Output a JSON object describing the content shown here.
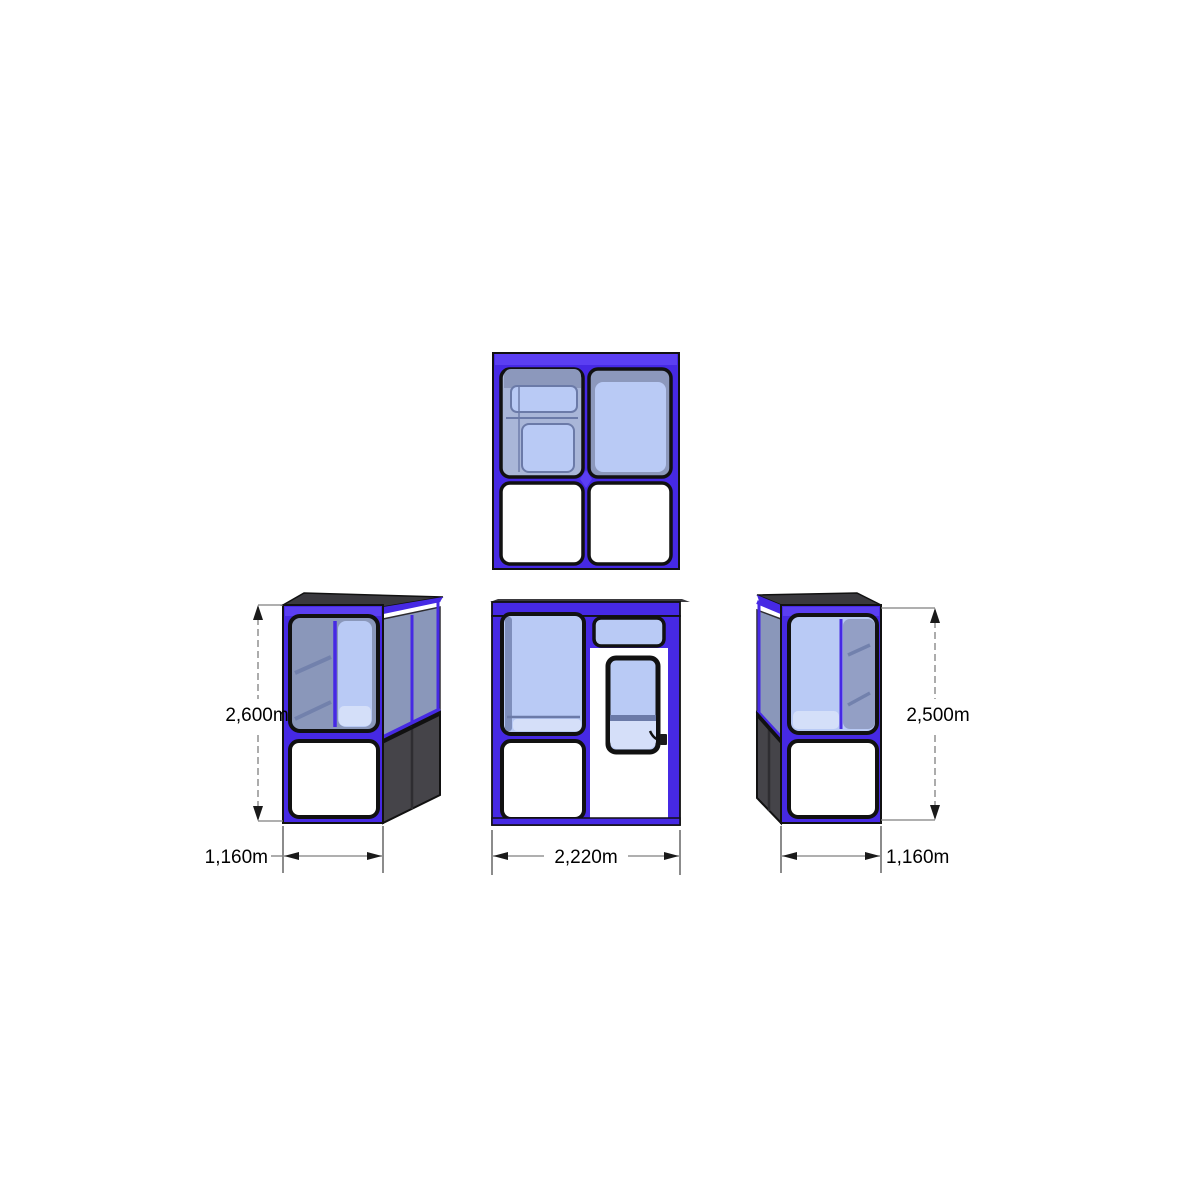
{
  "title": "kiosk-booth-orthographic-drawing",
  "colors": {
    "page_bg": "#ffffff",
    "frame_blue": "#4629E4",
    "frame_blue_light": "#5B3FF2",
    "outline": "#111111",
    "glass_light": "#B9CAF5",
    "glass_lighter": "#D5DFF9",
    "glass_mid": "#A9B6D8",
    "glass_tint": "#8C98BC",
    "glass_side": "#8A97BA",
    "divider_blue": "#6B7AA8",
    "side_dark": "#454449",
    "side_seam": "#2E2D31",
    "roof_dark": "#3A393E",
    "panel_white": "#FFFFFF",
    "dim_gray": "#7F7F7F",
    "dim_black": "#1A1A1A",
    "text": "#000000"
  },
  "views": {
    "top": {
      "name": "top plan view"
    },
    "left": {
      "name": "left perspective view",
      "height_label": "2,600m",
      "width_label": "1,160m"
    },
    "front": {
      "name": "front elevation view",
      "width_label": "2,220m"
    },
    "right": {
      "name": "right perspective view",
      "height_label": "2,500m",
      "width_label": "1,160m"
    }
  }
}
